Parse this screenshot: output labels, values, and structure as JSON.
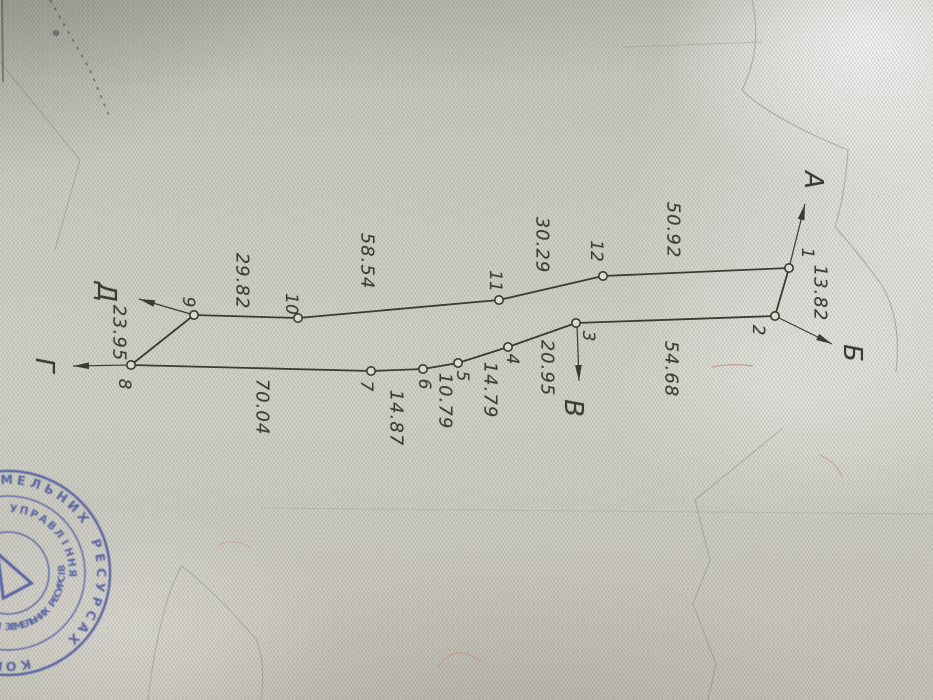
{
  "plan": {
    "ink_color": "#3b3b33",
    "points": [
      {
        "id": "1",
        "x": 789,
        "y": 268,
        "lx": 807,
        "ly": 253
      },
      {
        "id": "2",
        "x": 775,
        "y": 316,
        "lx": 758,
        "ly": 330
      },
      {
        "id": "3",
        "x": 576,
        "y": 323,
        "lx": 588,
        "ly": 336
      },
      {
        "id": "4",
        "x": 508,
        "y": 347,
        "lx": 512,
        "ly": 359
      },
      {
        "id": "5",
        "x": 458,
        "y": 363,
        "lx": 462,
        "ly": 376
      },
      {
        "id": "6",
        "x": 423,
        "y": 369,
        "lx": 424,
        "ly": 384
      },
      {
        "id": "7",
        "x": 371,
        "y": 371,
        "lx": 366,
        "ly": 386
      },
      {
        "id": "8",
        "x": 131,
        "y": 365,
        "lx": 124,
        "ly": 384
      },
      {
        "id": "9",
        "x": 194,
        "y": 315,
        "lx": 188,
        "ly": 302
      },
      {
        "id": "10",
        "x": 298,
        "y": 318,
        "lx": 291,
        "ly": 304
      },
      {
        "id": "11",
        "x": 499,
        "y": 300,
        "lx": 495,
        "ly": 281
      },
      {
        "id": "12",
        "x": 603,
        "y": 276,
        "lx": 596,
        "ly": 251
      }
    ],
    "segments": [
      {
        "from": "1",
        "to": "2",
        "length": "13.82",
        "lx": 820,
        "ly": 293
      },
      {
        "from": "2",
        "to": "3",
        "length": "54.68",
        "lx": 671,
        "ly": 369
      },
      {
        "from": "3",
        "to": "4",
        "length": "20.95",
        "lx": 547,
        "ly": 368
      },
      {
        "from": "4",
        "to": "5",
        "length": "14.79",
        "lx": 490,
        "ly": 390
      },
      {
        "from": "5",
        "to": "6",
        "length": "10.79",
        "lx": 445,
        "ly": 401
      },
      {
        "from": "6",
        "to": "7",
        "length": "14.87",
        "lx": 396,
        "ly": 418
      },
      {
        "from": "7",
        "to": "8",
        "length": "70.04",
        "lx": 262,
        "ly": 407
      },
      {
        "from": "8",
        "to": "9",
        "length": "23.95",
        "lx": 119,
        "ly": 333
      },
      {
        "from": "9",
        "to": "10",
        "length": "29.82",
        "lx": 242,
        "ly": 281
      },
      {
        "from": "10",
        "to": "11",
        "length": "58.54",
        "lx": 367,
        "ly": 261
      },
      {
        "from": "11",
        "to": "12",
        "length": "30.29",
        "lx": 542,
        "ly": 245
      },
      {
        "from": "12",
        "to": "1",
        "length": "50.92",
        "lx": 673,
        "ly": 230
      }
    ],
    "directions": [
      {
        "letter": "А",
        "x1": 789,
        "y1": 268,
        "x2": 805,
        "y2": 204,
        "lx": 813,
        "ly": 180
      },
      {
        "letter": "Б",
        "x1": 775,
        "y1": 316,
        "x2": 832,
        "y2": 344,
        "lx": 852,
        "ly": 353
      },
      {
        "letter": "В",
        "x1": 577,
        "y1": 325,
        "x2": 579,
        "y2": 381,
        "lx": 573,
        "ly": 408
      },
      {
        "letter": "Г",
        "x1": 131,
        "y1": 365,
        "x2": 73,
        "y2": 366,
        "lx": 44,
        "ly": 365
      },
      {
        "letter": "Д",
        "x1": 194,
        "y1": 315,
        "x2": 139,
        "y2": 299,
        "lx": 106,
        "ly": 292
      }
    ]
  },
  "stamp": {
    "ink": "#3e4c9b",
    "outer_ring": "КОМІТЕТ УКРАЇНИ ПО ЗЕМЕЛЬНИХ РЕСУРСАХ",
    "upper_arc": "ОБЛАСНЕ ГОЛОВНЕ УПРАВЛІННЯ",
    "lower_arc": "ВІДДІЛ ЗЕМЕЛЬНИХ РЕСУРСІВ"
  },
  "paper": {
    "base_color": "#cfd1c8",
    "pattern_color": "#9aa894",
    "fiber_mark_color": "#c06a72"
  }
}
